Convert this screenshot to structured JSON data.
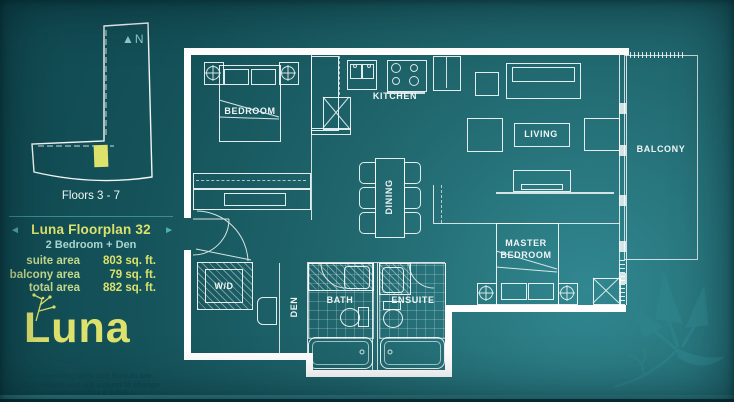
{
  "colors": {
    "background_teal": "#17565c",
    "accent_yellow_green": "#dde26c",
    "pale_green_label": "#c3d98d",
    "light_teal": "#7fc9c4",
    "plan_line_white": "#ffffff"
  },
  "sidebar": {
    "north_label": "N",
    "floors_label": "Floors 3 - 7",
    "prev_arrow": "◄",
    "next_arrow": "►",
    "plan_title": "Luna Floorplan 32",
    "plan_subtitle": "2 Bedroom + Den",
    "areas": [
      {
        "label": "suite area",
        "value": "803 sq. ft."
      },
      {
        "label": "balcony area",
        "value": "79 sq. ft."
      },
      {
        "label": "total area",
        "value": "882 sq. ft."
      }
    ],
    "logo_text": "Luna",
    "disclaimer": "Dimensions, sizes and layouts are approximate and are subject to change without notice E.&O.E."
  },
  "floorplan": {
    "rooms": {
      "bedroom": "BEDROOM",
      "kitchen": "KITCHEN",
      "dining": "DINING",
      "living": "LIVING",
      "balcony": "BALCONY",
      "master_line1": "MASTER",
      "master_line2": "BEDROOM",
      "wd": "W/D",
      "den": "DEN",
      "bath": "BATH",
      "ensuite": "ENSUITE"
    }
  }
}
